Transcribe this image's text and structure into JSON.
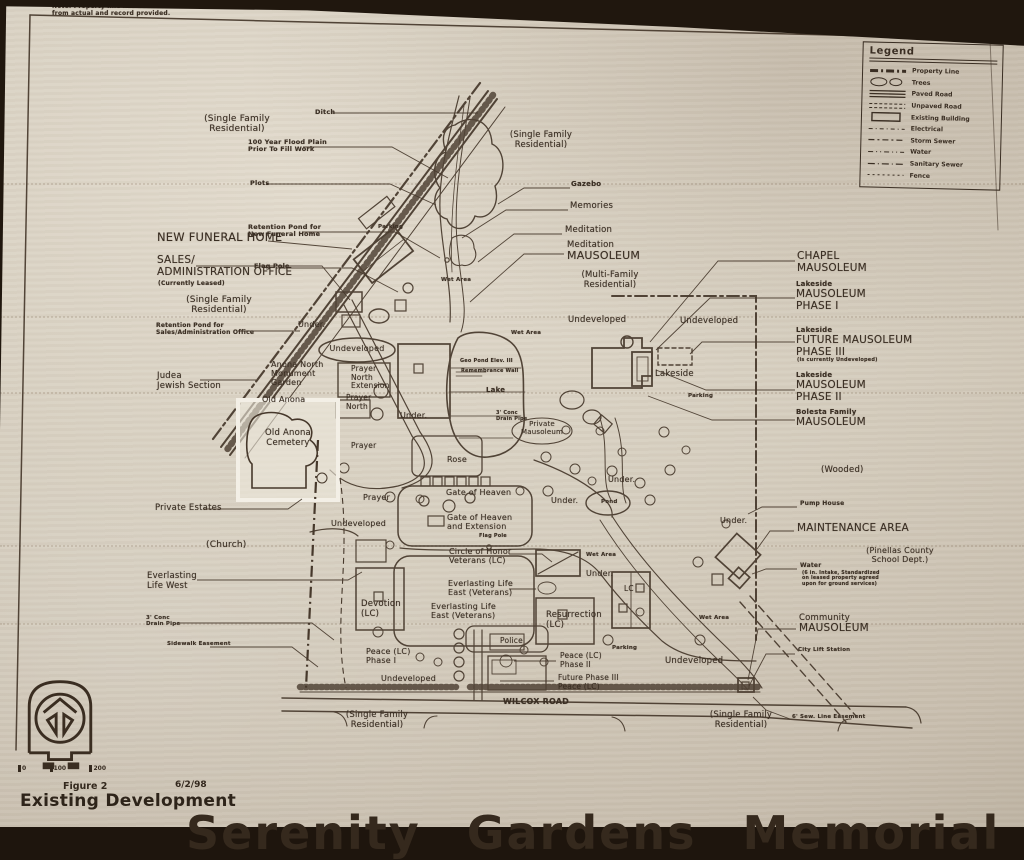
{
  "document": {
    "figure_label": "Figure 2",
    "date": "6/2/98",
    "figure_title": "Existing Development",
    "cutoff_title": "Serenity Gardens Memorial",
    "scale_ticks": [
      "0",
      "100",
      "200"
    ]
  },
  "colors": {
    "paper": "#d6cebf",
    "ink": "#3a2d21",
    "photo_background": "#20170e",
    "highlight_box": "#efe9dc"
  },
  "legend": {
    "title": "Legend",
    "items": [
      {
        "symbol": "property-line",
        "label": "Property Line"
      },
      {
        "symbol": "trees",
        "label": "Trees"
      },
      {
        "symbol": "paved-road",
        "label": "Paved Road"
      },
      {
        "symbol": "unpaved-road",
        "label": "Unpaved Road"
      },
      {
        "symbol": "existing-building",
        "label": "Existing Building"
      },
      {
        "symbol": "electrical",
        "label": "Electrical"
      },
      {
        "symbol": "storm-sewer",
        "label": "Storm Sewer"
      },
      {
        "symbol": "water",
        "label": "Water"
      },
      {
        "symbol": "sanitary-sewer",
        "label": "Sanitary Sewer"
      },
      {
        "symbol": "fence",
        "label": "Fence"
      }
    ]
  },
  "map": {
    "labels": [
      {
        "t": "Note: Property line has been identified\nfrom actual and record provided.",
        "x": 52,
        "y": 4,
        "s": 6,
        "b": true
      },
      {
        "t": "(Single Family\nResidential)",
        "x": 237,
        "y": 114,
        "s": 9,
        "c": true
      },
      {
        "t": "Ditch",
        "x": 315,
        "y": 109,
        "s": 6.5,
        "b": true
      },
      {
        "t": "100 Year Flood Plain\nPrior To Fill Work",
        "x": 248,
        "y": 139,
        "s": 6.5,
        "b": true
      },
      {
        "t": "Plots",
        "x": 250,
        "y": 180,
        "s": 6.5,
        "b": true
      },
      {
        "t": "Retention Pond for\nNew Funeral Home",
        "x": 248,
        "y": 224,
        "s": 6.5,
        "b": true
      },
      {
        "t": "Flag Pole",
        "x": 254,
        "y": 263,
        "s": 6.5,
        "b": true
      },
      {
        "t": "NEW FUNERAL HOME",
        "x": 157,
        "y": 231,
        "s": 11.5
      },
      {
        "t": "SALES/\nADMINISTRATION OFFICE",
        "x": 157,
        "y": 255,
        "s": 10.5
      },
      {
        "t": "(Currently Leased)",
        "x": 158,
        "y": 281,
        "s": 6,
        "b": true
      },
      {
        "t": "(Single Family\nResidential)",
        "x": 219,
        "y": 295,
        "s": 9,
        "c": true
      },
      {
        "t": "Retention Pond for\nSales/Administration Office",
        "x": 156,
        "y": 323,
        "s": 6,
        "b": true
      },
      {
        "t": "Judea\nJewish Section",
        "x": 157,
        "y": 372,
        "s": 8.5
      },
      {
        "t": "Anona North\nMonument\nGarden",
        "x": 271,
        "y": 360,
        "s": 8
      },
      {
        "t": "Prayer\nNorth\nExtension",
        "x": 351,
        "y": 365,
        "s": 7.5
      },
      {
        "t": "Old Anona",
        "x": 262,
        "y": 395,
        "s": 8
      },
      {
        "t": "Prayer\nNorth",
        "x": 346,
        "y": 394,
        "s": 7.5
      },
      {
        "t": "Old Anona\nCemetery",
        "x": 288,
        "y": 429,
        "s": 8.5,
        "c": true
      },
      {
        "t": "Prayer",
        "x": 351,
        "y": 442,
        "s": 7.5
      },
      {
        "t": "Prayer",
        "x": 363,
        "y": 493,
        "s": 8
      },
      {
        "t": "Private Estates",
        "x": 155,
        "y": 504,
        "s": 8.5
      },
      {
        "t": "(Church)",
        "x": 206,
        "y": 540,
        "s": 9
      },
      {
        "t": "Everlasting\nLife West",
        "x": 147,
        "y": 572,
        "s": 8.5
      },
      {
        "t": "3' Conc\nDrain Pipe",
        "x": 146,
        "y": 615,
        "s": 5.5,
        "b": true
      },
      {
        "t": "Sidewalk Easement",
        "x": 167,
        "y": 641,
        "s": 5.5,
        "b": true
      },
      {
        "t": "Undeveloped",
        "x": 331,
        "y": 519,
        "s": 8
      },
      {
        "t": "Devotion\n(LC)",
        "x": 361,
        "y": 600,
        "s": 8.5
      },
      {
        "t": "Peace (LC)\nPhase I",
        "x": 366,
        "y": 647,
        "s": 8
      },
      {
        "t": "Undeveloped",
        "x": 381,
        "y": 674,
        "s": 8
      },
      {
        "t": "Police",
        "x": 500,
        "y": 637,
        "s": 7.5
      },
      {
        "t": "Peace (LC)\nPhase II",
        "x": 560,
        "y": 652,
        "s": 7.5
      },
      {
        "t": "Future Phase III\nPeace (LC)",
        "x": 558,
        "y": 674,
        "s": 7.5
      },
      {
        "t": "Resurrection\n(LC)",
        "x": 546,
        "y": 611,
        "s": 8.5
      },
      {
        "t": "Everlasting Life\nEast (Veterans)",
        "x": 448,
        "y": 579,
        "s": 8
      },
      {
        "t": "Everlasting Life\nEast (Veterans)",
        "x": 431,
        "y": 602,
        "s": 8
      },
      {
        "t": "Circle of Honor\nVeterans (LC)",
        "x": 449,
        "y": 547,
        "s": 8
      },
      {
        "t": "Gate of Heaven",
        "x": 446,
        "y": 488,
        "s": 8
      },
      {
        "t": "Gate of Heaven\nand Extension",
        "x": 447,
        "y": 513,
        "s": 8
      },
      {
        "t": "Flag Pole",
        "x": 479,
        "y": 534,
        "s": 5,
        "b": true
      },
      {
        "t": "Rose",
        "x": 447,
        "y": 455,
        "s": 8
      },
      {
        "t": "Lake",
        "x": 486,
        "y": 387,
        "s": 7,
        "b": true
      },
      {
        "t": "Geo Pond Elev. III",
        "x": 460,
        "y": 359,
        "s": 5,
        "b": true
      },
      {
        "t": "Remembrance Wall",
        "x": 461,
        "y": 369,
        "s": 5,
        "b": true
      },
      {
        "t": "3' Conc\nDrain Pipe",
        "x": 496,
        "y": 411,
        "s": 5,
        "b": true
      },
      {
        "t": "Private\nMausoleum",
        "x": 542,
        "y": 421,
        "s": 7,
        "c": true
      },
      {
        "t": "Wet Area",
        "x": 441,
        "y": 277,
        "s": 5.5,
        "b": true
      },
      {
        "t": "Wet Area",
        "x": 511,
        "y": 330,
        "s": 5.5,
        "b": true
      },
      {
        "t": "Wet Area",
        "x": 586,
        "y": 552,
        "s": 5.5,
        "b": true
      },
      {
        "t": "Wet Area",
        "x": 699,
        "y": 615,
        "s": 5.5,
        "b": true
      },
      {
        "t": "Under.",
        "x": 298,
        "y": 320,
        "s": 8
      },
      {
        "t": "Under.",
        "x": 400,
        "y": 411,
        "s": 8
      },
      {
        "t": "Under.",
        "x": 551,
        "y": 496,
        "s": 8
      },
      {
        "t": "Under.",
        "x": 608,
        "y": 475,
        "s": 8
      },
      {
        "t": "Under.",
        "x": 586,
        "y": 569,
        "s": 8
      },
      {
        "t": "Under.",
        "x": 720,
        "y": 516,
        "s": 8
      },
      {
        "t": "Undeveloped",
        "x": 357,
        "y": 344,
        "s": 8,
        "c": true
      },
      {
        "t": "Undeveloped",
        "x": 568,
        "y": 316,
        "s": 8.5
      },
      {
        "t": "Undeveloped",
        "x": 680,
        "y": 317,
        "s": 8.5
      },
      {
        "t": "Lakeside",
        "x": 655,
        "y": 370,
        "s": 8.5
      },
      {
        "t": "Parking",
        "x": 688,
        "y": 393,
        "s": 5.5,
        "b": true
      },
      {
        "t": "Parking",
        "x": 378,
        "y": 224,
        "s": 5.5,
        "b": true
      },
      {
        "t": "Parking",
        "x": 612,
        "y": 645,
        "s": 5.5,
        "b": true
      },
      {
        "t": "Gazebo",
        "x": 571,
        "y": 181,
        "s": 7,
        "b": true
      },
      {
        "t": "Memories",
        "x": 570,
        "y": 202,
        "s": 8.5
      },
      {
        "t": "Meditation",
        "x": 565,
        "y": 226,
        "s": 8.5
      },
      {
        "t": "Meditation",
        "x": 567,
        "y": 241,
        "s": 8.5
      },
      {
        "t": "MAUSOLEUM",
        "x": 567,
        "y": 250,
        "s": 11
      },
      {
        "t": "(Multi-Family\nResidential)",
        "x": 610,
        "y": 271,
        "s": 8.5,
        "c": true
      },
      {
        "t": "(Single Family\nResidential)",
        "x": 541,
        "y": 131,
        "s": 8.5,
        "c": true
      },
      {
        "t": "CHAPEL\nMAUSOLEUM",
        "x": 797,
        "y": 251,
        "s": 10.5
      },
      {
        "t": "Lakeside",
        "x": 796,
        "y": 281,
        "s": 7,
        "b": true
      },
      {
        "t": "MAUSOLEUM\nPHASE I",
        "x": 796,
        "y": 289,
        "s": 10.5
      },
      {
        "t": "Lakeside",
        "x": 796,
        "y": 327,
        "s": 7,
        "b": true
      },
      {
        "t": "FUTURE MAUSOLEUM\nPHASE III",
        "x": 796,
        "y": 335,
        "s": 10.5
      },
      {
        "t": "(is currently Undeveloped)",
        "x": 797,
        "y": 358,
        "s": 5,
        "b": true
      },
      {
        "t": "Lakeside",
        "x": 796,
        "y": 372,
        "s": 7,
        "b": true
      },
      {
        "t": "MAUSOLEUM\nPHASE II",
        "x": 796,
        "y": 380,
        "s": 10.5
      },
      {
        "t": "Bolesta Family",
        "x": 796,
        "y": 409,
        "s": 7,
        "b": true
      },
      {
        "t": "MAUSOLEUM",
        "x": 796,
        "y": 417,
        "s": 10.5
      },
      {
        "t": "(Wooded)",
        "x": 821,
        "y": 466,
        "s": 8.5
      },
      {
        "t": "Pump House",
        "x": 800,
        "y": 501,
        "s": 6,
        "b": true
      },
      {
        "t": "MAINTENANCE AREA",
        "x": 797,
        "y": 523,
        "s": 10.5
      },
      {
        "t": "(Pinellas County\nSchool Dept.)",
        "x": 900,
        "y": 546,
        "s": 8,
        "c": true
      },
      {
        "t": "Water",
        "x": 800,
        "y": 563,
        "s": 6,
        "b": true
      },
      {
        "t": "(6 in. Intake, Standardized\non leased property agreed\nupon for ground services)",
        "x": 802,
        "y": 571,
        "s": 4.8,
        "b": true
      },
      {
        "t": "Community",
        "x": 799,
        "y": 614,
        "s": 8.5
      },
      {
        "t": "MAUSOLEUM",
        "x": 799,
        "y": 623,
        "s": 10.5
      },
      {
        "t": "City Lift Station",
        "x": 798,
        "y": 647,
        "s": 5.5,
        "b": true
      },
      {
        "t": "Undeveloped",
        "x": 665,
        "y": 657,
        "s": 8.5
      },
      {
        "t": "Pond",
        "x": 601,
        "y": 499,
        "s": 5.5,
        "b": true
      },
      {
        "t": "LC",
        "x": 624,
        "y": 585,
        "s": 7.5
      },
      {
        "t": "(Single Family\nResidential)",
        "x": 741,
        "y": 711,
        "s": 8.5,
        "c": true
      },
      {
        "t": "6' Sew. Line Easement",
        "x": 792,
        "y": 714,
        "s": 5.5,
        "b": true
      },
      {
        "t": "WILCOX ROAD",
        "x": 536,
        "y": 697,
        "s": 8,
        "c": true,
        "b": true
      },
      {
        "t": "(Single Family\nResidential)",
        "x": 377,
        "y": 711,
        "s": 8.5,
        "c": true
      }
    ]
  }
}
